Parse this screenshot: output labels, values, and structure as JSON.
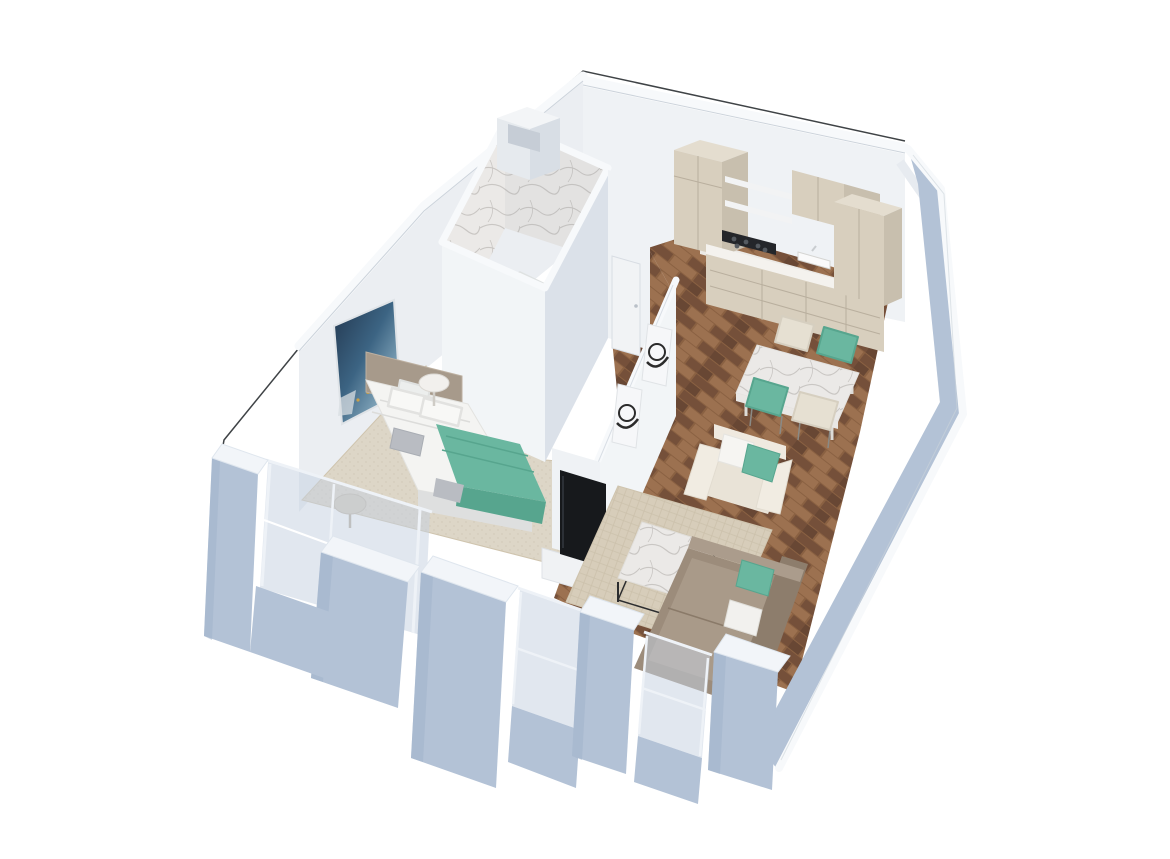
{
  "meta": {
    "description": "3D isometric cutaway rendering of a one-bedroom apartment floor plan on a white background",
    "view": "axonometric-top-down, unit rotated, cut walls shown with white tops",
    "visible_text": "none"
  },
  "palette": {
    "bg": "#ffffff",
    "outline": "#3f4346",
    "wall_top": "#f7f9fb",
    "wall_edge": "#ccd3db",
    "wall_nw": "#ebeef2",
    "wall_face_light": "#eff2f5",
    "wall_face_bright": "#f2f5f7",
    "wall_face": "#e7ebf0",
    "wall_face_shadow": "#dbe1e9",
    "ext_blue": "#b3c2d6",
    "ext_blue_dark": "#9fb2c9",
    "ext_top": "#f2f5f9",
    "glass": "#c6d1e0",
    "glass_frame": "#eef2f7",
    "seam": "#7d8ca0",
    "wood_a": "#8a6142",
    "wood_b": "#75503a",
    "wood_c": "#9c7150",
    "wood_d": "#684734",
    "carpet": "#ddd6c7",
    "carpet_dot": "#cfc7b6",
    "rug": "#d7cdba",
    "rug_line": "#ccc1ab",
    "rug_edge": "#cfc4ae",
    "marble_base": "#ebe9e7",
    "marble_vein": "#c9c6c3",
    "cab_face": "#d8cfbe",
    "cab_side": "#c8bfae",
    "cab_top": "#e4ddcf",
    "cab_seam": "#b9af9e",
    "counter": "#f4f2ee",
    "cooktop": "#24262a",
    "teal": "#6ab7a0",
    "teal_dark": "#57a58e",
    "cream_chair": "#e6e0d2",
    "sofa": "#9c8c7b",
    "sofa_light": "#ab9c8c",
    "pillow_white": "#f2f1ee",
    "bed_white": "#f4f4f2",
    "bed_shadow": "#dedfdf",
    "headboard": "#a79a8b",
    "pillow_gray": "#b9bcc2",
    "table_leg": "#2c2d2f",
    "tv": "#17191c",
    "console": "#f0f2f4",
    "art_navy": "#22364e",
    "art_blue": "#3c6483",
    "art_teal": "#7fa3b8",
    "art_light": "#c9d3d8",
    "art_gold": "#c8a04a",
    "frame_white": "#f6f7f9",
    "art_ink": "#2b2b2b",
    "door": "#f1f3f5"
  },
  "scene": {
    "type": "3d-floor-plan-render",
    "rooms": [
      {
        "name": "bathroom",
        "features": [
          "marble-shower-walls",
          "bathtub",
          "shower-head",
          "service-shaft-box"
        ]
      },
      {
        "name": "bedroom",
        "features": [
          "double-bed",
          "taupe-headboard",
          "white-pillows",
          "gray-pillow",
          "teal-blanket",
          "round-side-table-white",
          "round-side-table-taupe",
          "abstract-blue-gold-wall-art",
          "beige-carpet",
          "floor-to-ceiling-glass-windows"
        ]
      },
      {
        "name": "hallway",
        "features": [
          "white-door",
          "two-framed-black-white-prints",
          "wood-parquet-floor"
        ]
      },
      {
        "name": "kitchen",
        "features": [
          "tall-pantry-cabinet",
          "open-shelves",
          "upper-cabinets",
          "gas-cooktop",
          "sink",
          "white-countertop",
          "base-cabinets-with-drawers",
          "tall-unit-right"
        ]
      },
      {
        "name": "dining-area",
        "features": [
          "marble-top-dining-table",
          "teal-chair-x2",
          "cream-chair-x2"
        ]
      },
      {
        "name": "living-room",
        "features": [
          "corner-sofa-taupe",
          "teal-cushion",
          "white-cushion",
          "marble-coffee-table",
          "woven-area-rug",
          "tv",
          "tv-console",
          "white-cube-armchair-with-teal-pillow"
        ]
      }
    ],
    "exterior": [
      "thin-black-plan-outline-top-left",
      "blue-gray-facade-walls",
      "window-openings-with-glass",
      "stepped-right-wall"
    ]
  }
}
